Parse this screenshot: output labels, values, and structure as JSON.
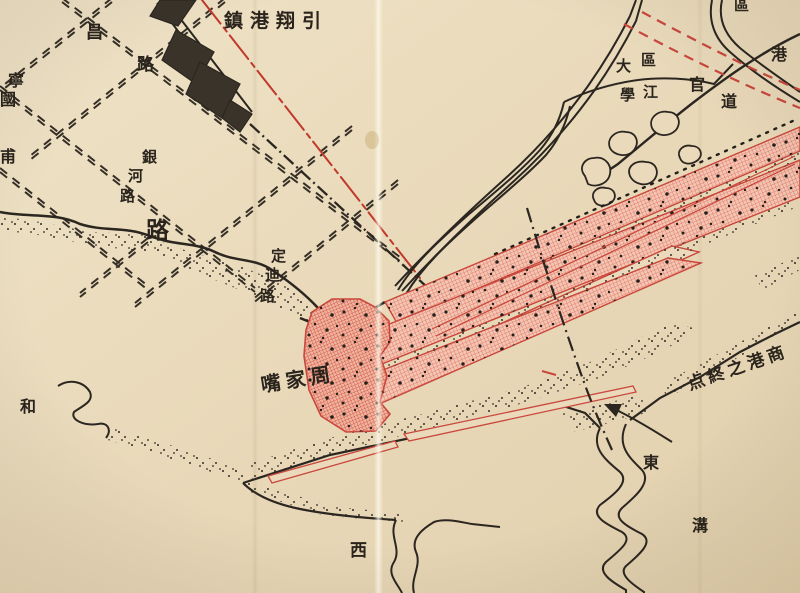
{
  "map": {
    "kind": "historical-scanned-map",
    "colors": {
      "paper": "#ead9bb",
      "ink": "#2b2620",
      "port_fill_light": "#f4c5b3",
      "port_hatch_red": "#d96a56",
      "port_outline_red": "#c9473c",
      "boundary_red": "#c0392b",
      "planned_road_red": "#d0413a"
    }
  },
  "labels": {
    "town_yinxiangang": {
      "text": "鎮港翔引"
    },
    "road_chang": {
      "c0": "昌",
      "c1": "路"
    },
    "road_ningguo": {
      "c0": "寧",
      "c1": "國"
    },
    "edge_pu": {
      "text": "甫"
    },
    "road_yinhe": {
      "c0": "銀",
      "c1": "河",
      "c2": "路"
    },
    "road_lu_big": {
      "text": "路"
    },
    "road_dingdi": {
      "c0": "定",
      "c1": "迪",
      "c2": "路"
    },
    "point_zhoujiazui": {
      "text": "嘴家周"
    },
    "col_daxue": {
      "c0": "大",
      "c1": "學"
    },
    "col_qujiang": {
      "c0": "區",
      "c1": "江"
    },
    "road_guandao": {
      "c0": "官",
      "c1": "道"
    },
    "edge_gang": {
      "text": "港"
    },
    "edge_qu_top": {
      "text": "區"
    },
    "note_port_end": {
      "text": "点終之港商"
    },
    "creek_dong": {
      "c0": "東",
      "c1": "溝"
    },
    "creek_xi": {
      "text": "西"
    },
    "label_he": {
      "text": "和"
    }
  }
}
